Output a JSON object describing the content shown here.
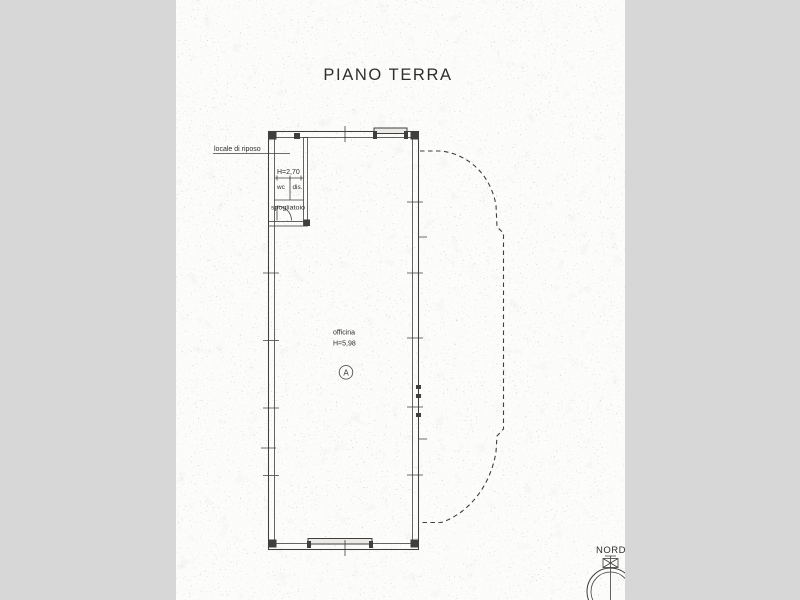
{
  "title": "PIANO TERRA",
  "labels": {
    "rest_room": "locale di riposo",
    "small_height": "H=2,70",
    "wc": "wc",
    "dis": "dis.",
    "changing_room": "spogliatoio",
    "workshop": "officina",
    "workshop_height": "H=5,98",
    "marker": "A",
    "north": "NORD"
  },
  "colors": {
    "margin": "#d7d7d7",
    "paper": "#fcfcfb",
    "ink": "#3f3f3f",
    "text": "#2e2e2e"
  }
}
